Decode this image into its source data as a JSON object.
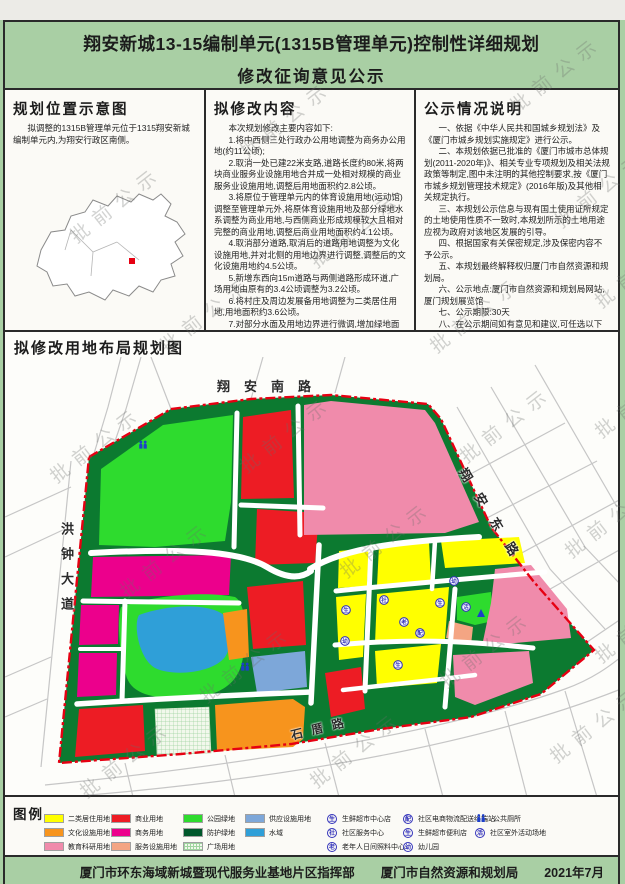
{
  "title": {
    "line1": "翔安新城13-15编制单元(1315B管理单元)控制性详细规划",
    "line2": "修改征询意见公示"
  },
  "watermark": "批前公示",
  "location_panel": {
    "heading": "规划位置示意图",
    "body": "拟调整的1315B管理单元位于1315翔安新城编制单元内,为翔安行政区南侧。"
  },
  "content_panel": {
    "heading": "拟修改内容",
    "intro": "本次规划修改主要内容如下:",
    "items": [
      "1.将中西侧三处行政办公用地调整为商务办公用地(约11公顷);",
      "2.取消一处已建22米支路,道路长度约80米,将两块商业服务业设施用地合并成一处相对规模的商业服务业设施用地,调整后用地面积约2.8公顷。",
      "3.将原位于管理单元内的体育设施用地(运动馆)调整至管理单元外,将原体育设施用地及部分绿地水系调整为商业用地,与西侧商业形成规模较大且相对完整的商业用地,调整后商业用地面积约4.1公顷。",
      "4.取消部分道路,取消后的道路用地调整为文化设施用地,并对北侧的用地边界进行调整,调整后的文化设施用地约4.5公顷。",
      "5.新增东西向15m道路与两侧道路形成环道,广场用地由原有的3.4公顷调整为3.2公顷。",
      "6.将村庄及周边发展备用地调整为二类居住用地,用地面积约3.6公顷。",
      "7.对部分水面及用地边界进行微调,增加绿地面积。"
    ]
  },
  "notes_panel": {
    "heading": "公示情况说明",
    "items": [
      "一、依据《中华人民共和国城乡规划法》及《厦门市城乡规划实施规定》进行公示。",
      "二、本规划依据已批准的《厦门市城市总体规划(2011-2020年)》、相关专业专项规划及相关法规政策等制定,图中未注明的其他控制要求,按《厦门市城乡规划管理技术规定》(2016年版)及其他相关规定执行。",
      "三、本规划公示信息与现有国土使用证所规定的土地使用性质不一致时,本规划所示的土地用途应视为政府对该地区发展的引导。",
      "四、根据国家有关保密规定,涉及保密内容不予公示。",
      "五、本规划最终解释权归厦门市自然资源和规划局。",
      "六、公示地点:厦门市自然资源和规划局网站, 厦门规划展览馆",
      "七、公示期限:30天",
      "八、在公示期间如有意见和建议,可任选以下方式反馈:",
      "厦门市自然资源和规划局网站: zygh.xm.gov.cn",
      "厦门规划展览馆"
    ]
  },
  "map_panel": {
    "heading": "拟修改用地布局规划图",
    "roads": {
      "north": "翔安南路",
      "east": "翔安东路",
      "west": "洪钟大道",
      "south": "石厝路"
    },
    "markers": [
      "生",
      "社",
      "老",
      "配",
      "幼",
      "生",
      "生",
      "幼",
      "活"
    ],
    "boundary_color": "#e60012"
  },
  "legend": {
    "heading": "图例",
    "land_use": [
      {
        "label": "二类居住用地",
        "color": "#ffff00"
      },
      {
        "label": "文化设施用地",
        "color": "#f7941d"
      },
      {
        "label": "教育科研用地",
        "color": "#f08bab"
      },
      {
        "label": "商业用地",
        "color": "#ed1c24"
      },
      {
        "label": "商务用地",
        "color": "#ec008c"
      },
      {
        "label": "服务设施用地",
        "color": "#f4a583"
      },
      {
        "label": "公园绿地",
        "color": "#2edb2e"
      },
      {
        "label": "防护绿地",
        "color": "#00572b"
      },
      {
        "label": "广场用地",
        "color": "#e8f3e0"
      },
      {
        "label": "供应设施用地",
        "color": "#7da7d9"
      },
      {
        "label": "水域",
        "color": "#2f9fd8"
      }
    ],
    "facilities": [
      {
        "label": "生鲜超市中心店",
        "symbol": "生"
      },
      {
        "label": "社区服务中心",
        "symbol": "社"
      },
      {
        "label": "老年人日间照料中心",
        "symbol": "老"
      },
      {
        "label": "社区电商物流配送终端站",
        "symbol": "配"
      },
      {
        "label": "生鲜超市便利店",
        "symbol": "生"
      },
      {
        "label": "幼儿园",
        "symbol": "幼"
      },
      {
        "label": "公共厕所",
        "symbol": "restroom-people-icon"
      },
      {
        "label": "社区室外活动场地",
        "symbol": "活"
      }
    ]
  },
  "footer": {
    "org1": "厦门市环东海域新城暨现代服务业基地片区指挥部",
    "org2": "厦门市自然资源和规划局",
    "date": "2021年7月"
  }
}
